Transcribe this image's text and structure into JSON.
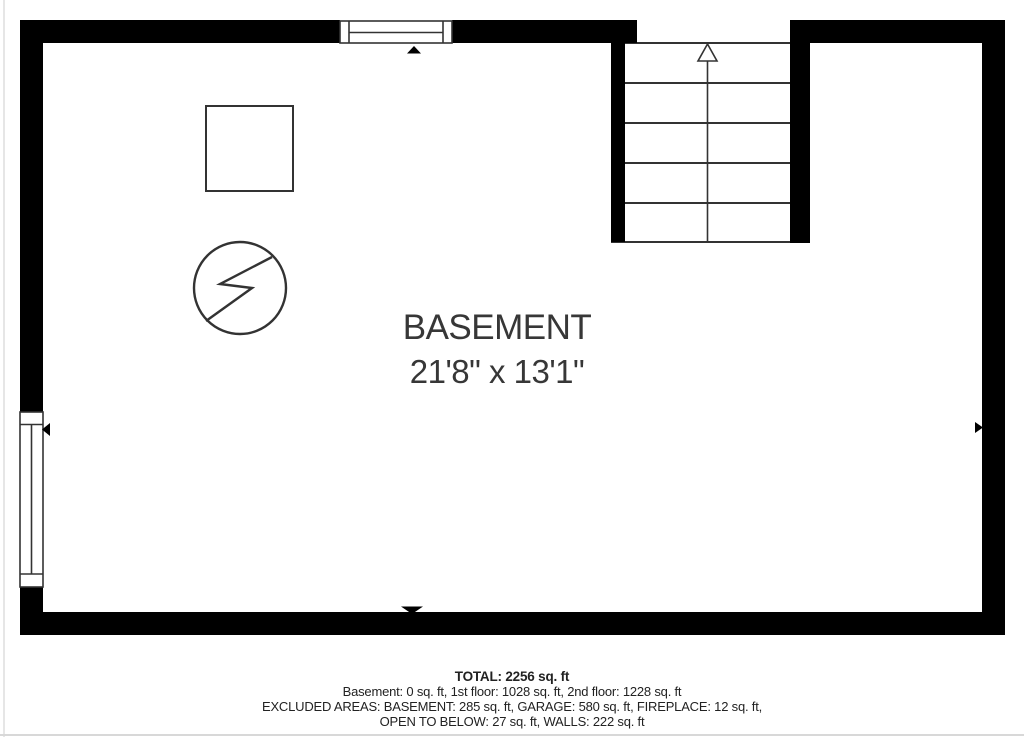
{
  "floorplan": {
    "room_label": "BASEMENT",
    "room_dimensions": "21'8\" x 13'1\"",
    "colors": {
      "wall": "#000000",
      "thin_line": "#333333",
      "label_text": "#373737",
      "summary_text": "#222222",
      "background": "#ffffff"
    },
    "symbols": {
      "stairs": "stairs-up-arrow",
      "top_window": "window",
      "left_window": "window",
      "square": "utility-box",
      "circle": "electrical-bolt-symbol",
      "dimension_markers": [
        "arrow-up",
        "arrow-down",
        "arrow-left",
        "arrow-right"
      ]
    }
  },
  "summary": {
    "total": "TOTAL: 2256 sq. ft",
    "floors": "Basement: 0 sq. ft, 1st floor: 1028 sq. ft, 2nd floor: 1228 sq. ft",
    "excluded_1": "EXCLUDED AREAS: BASEMENT: 285 sq. ft, GARAGE: 580 sq. ft, FIREPLACE: 12 sq. ft,",
    "excluded_2": "OPEN TO BELOW: 27 sq. ft, WALLS: 222 sq. ft"
  }
}
